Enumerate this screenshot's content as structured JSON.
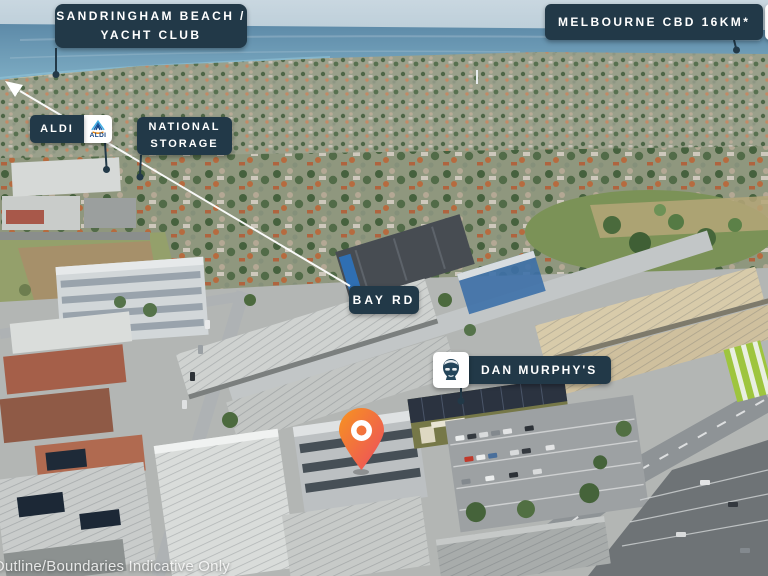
{
  "scene": {
    "type": "aerial-photo-location-map",
    "disclaimer": "Outline/Boundaries Indicative Only"
  },
  "labels": {
    "sandringham_beach": {
      "line1": "SANDRINGHAM BEACH /",
      "line2": "YACHT CLUB"
    },
    "melbourne_cbd": {
      "text": "MELBOURNE CBD 16KM*",
      "icon": "city-buildings-icon"
    },
    "aldi": {
      "text": "ALDI",
      "logo_text": "ALDI",
      "icon": "aldi-logo-icon"
    },
    "national_storage": {
      "line1": "NATIONAL",
      "line2": "STORAGE"
    },
    "bay_rd": {
      "text": "BAY RD"
    },
    "dan_murphys": {
      "text": "DAN MURPHY'S",
      "icon": "dan-murphys-portrait-icon"
    }
  },
  "marker": {
    "name": "subject-property-pin",
    "color_top": "#F79420",
    "color_bottom": "#EC4B5F",
    "ring_color": "#FFFFFF"
  },
  "colors": {
    "label_background": "#223948",
    "label_text": "#FFFFFF",
    "leader_line": "#223948",
    "route_line_to_beach": "#FFFFFF"
  }
}
